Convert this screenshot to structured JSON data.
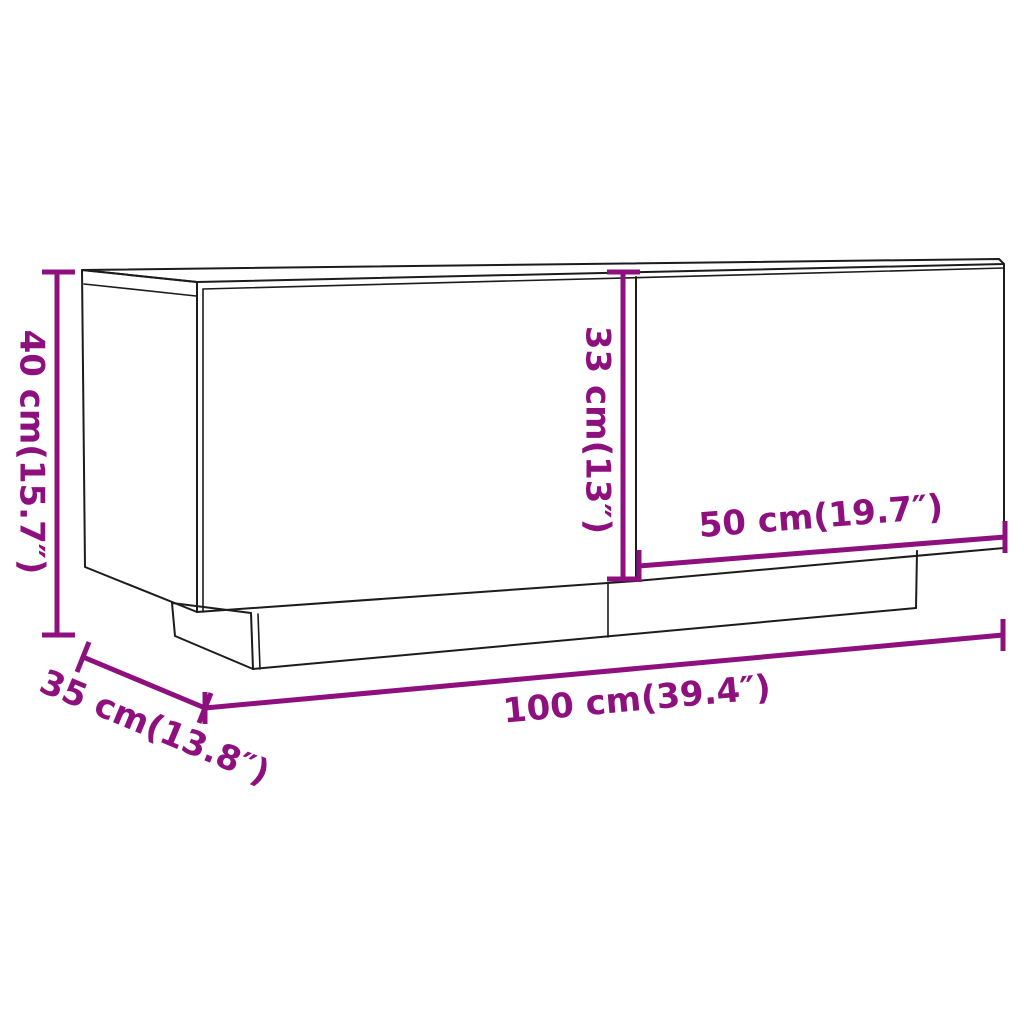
{
  "diagram": {
    "type": "product-dimension-diagram",
    "subject": "tv-cabinet-with-two-doors-on-plinth",
    "colors": {
      "background": "#ffffff",
      "outline": "#1c1c1c",
      "dimension": "#8E107E"
    },
    "dimensions": [
      {
        "id": "height",
        "label": "40 cm(15.7″)",
        "cm": 40,
        "inch": 15.7
      },
      {
        "id": "door_height",
        "label": "33 cm(13″)",
        "cm": 33,
        "inch": 13
      },
      {
        "id": "door_width",
        "label": "50 cm(19.7″)",
        "cm": 50,
        "inch": 19.7
      },
      {
        "id": "width",
        "label": "100 cm(39.4″)",
        "cm": 100,
        "inch": 39.4
      },
      {
        "id": "depth",
        "label": "35 cm(13.8″)",
        "cm": 35,
        "inch": 13.8
      }
    ]
  }
}
